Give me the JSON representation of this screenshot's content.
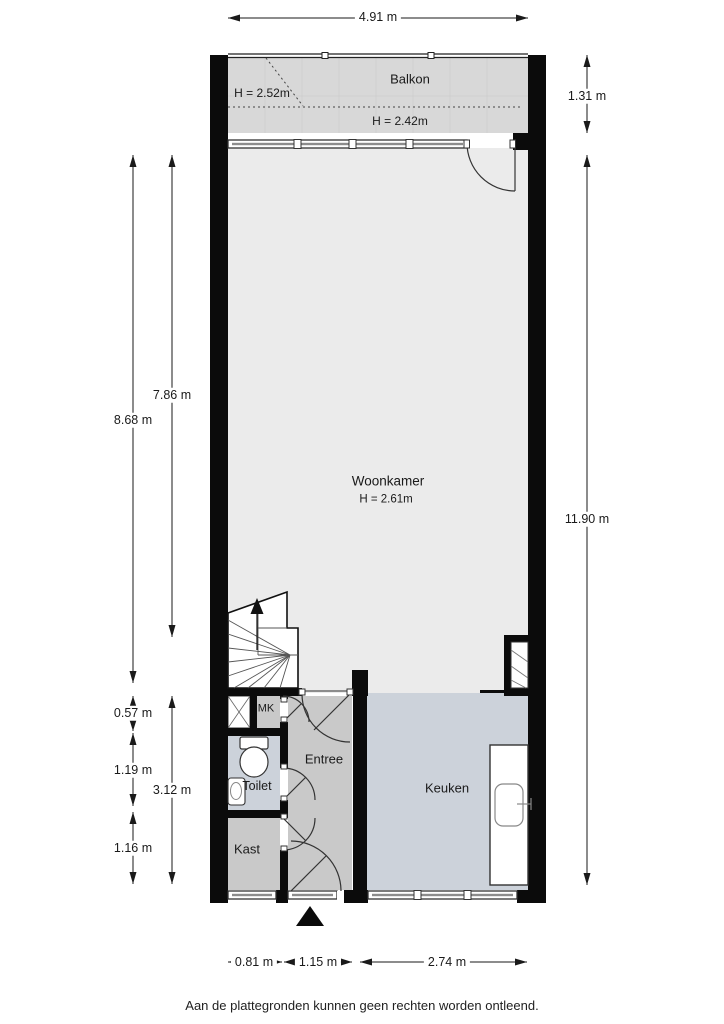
{
  "page": {
    "footer": "Aan de plattegronden kunnen geen rechten worden ontleend."
  },
  "rooms": {
    "balkon": {
      "label": "Balkon",
      "height_upper": "H = 2.52m",
      "height_lower": "H = 2.42m"
    },
    "woonkamer": {
      "label": "Woonkamer",
      "height": "H = 2.61m"
    },
    "mk": {
      "label": "MK"
    },
    "toilet": {
      "label": "Toilet"
    },
    "entree": {
      "label": "Entree"
    },
    "kast": {
      "label": "Kast"
    },
    "keuken": {
      "label": "Keuken"
    }
  },
  "dimensions": {
    "top_width": "4.91 m",
    "balkon_depth": "1.31 m",
    "right_total_height": "11.90 m",
    "left_woonkamer_total": "8.68 m",
    "left_woonkamer_inner": "7.86 m",
    "left_mk_depth": "0.57 m",
    "left_toilet_depth": "1.19 m",
    "left_lower_total": "3.12 m",
    "left_kast_depth": "1.16 m",
    "bottom_kast_width": "0.81 m",
    "bottom_entree_width": "1.15 m",
    "bottom_keuken_width": "2.74 m"
  },
  "colors": {
    "wall": "#0b0b0b",
    "woonkamer_fill": "#ebebeb",
    "balkon_fill": "#d8d8d8",
    "hall_fill": "#c9c9c9",
    "wet_room_fill": "#ccd2da",
    "dimension_text": "#1a1a1a"
  }
}
